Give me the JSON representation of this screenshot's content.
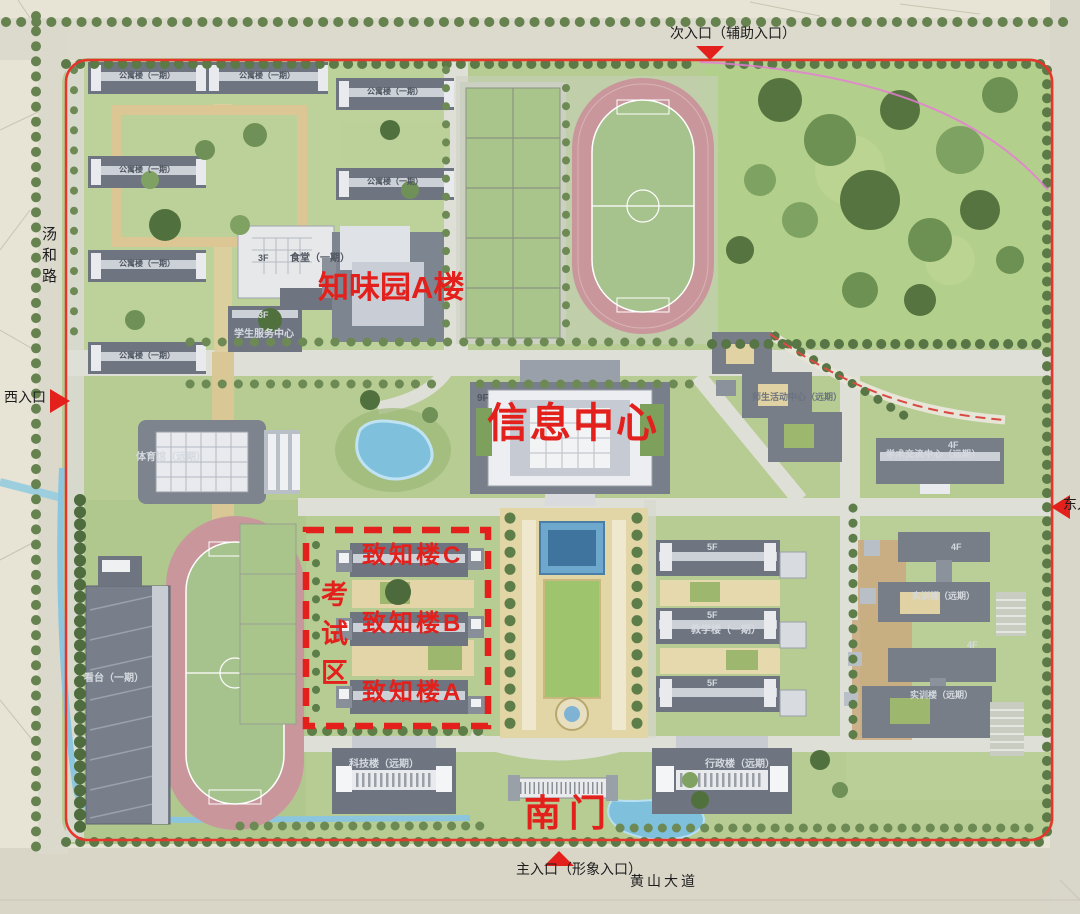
{
  "map": {
    "roads": {
      "west": "汤和路",
      "south": "黄山大道"
    },
    "entrances": {
      "north": "次入口（辅助入口）",
      "west": "西入口",
      "east": "东入口",
      "south_main": "主入口（形象入口）"
    },
    "red_annotations": {
      "zhiwei_hall": "知味园A楼",
      "info_center": "信息中心",
      "exam_zone": "考试区",
      "zhizhi_c": "致知楼C",
      "zhizhi_b": "致知楼B",
      "zhizhi_a": "致知楼A",
      "south_gate": "南门"
    },
    "buildings": {
      "dorm": "公寓楼（一期）",
      "canteen": "食堂（一期）",
      "canteen_floor": "3F",
      "student_service_center": "学生服务中心",
      "student_service_floor": "3F",
      "gymnasium": "体育馆（远期）",
      "grandstand": "看台（一期）",
      "info_center_floor": "9F",
      "teaching_building": "教学楼（一期）",
      "teaching_floor": "5F",
      "activity_center": "师生活动中心（远期）",
      "academic_exchange_center": "学术交流中心（远期）",
      "academic_floor": "4F",
      "training_building": "实训楼（远期）",
      "training_floor": "4F",
      "admin_building": "行政楼（远期）",
      "science_building": "科技楼（远期）"
    },
    "colors": {
      "annotation_red": "#e3201b",
      "boundary_red": "#e6352c",
      "lawn_green": "#b6cc93",
      "track_pink": "#c8969b",
      "water_blue": "#7fc0dc",
      "building_grey": "#6e7580"
    }
  }
}
